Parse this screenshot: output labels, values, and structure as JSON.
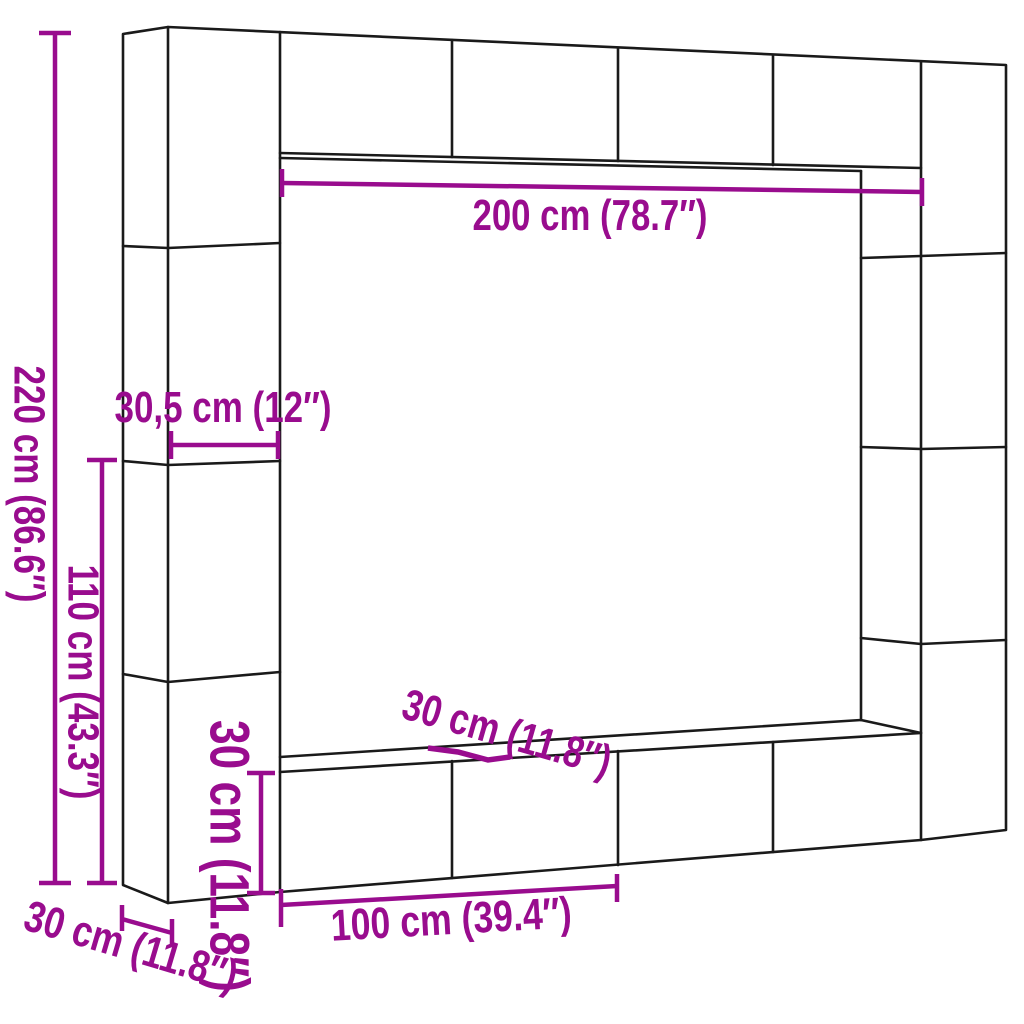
{
  "colors": {
    "dimension": "#990c8e",
    "outline": "#1a1a1a",
    "background": "#ffffff"
  },
  "dimensions": {
    "inner_width": {
      "label": "200 cm (78.7″)",
      "cm": "200",
      "inches": "78.7"
    },
    "total_height": {
      "label": "220 cm (86.6″)",
      "cm": "220",
      "inches": "86.6"
    },
    "column_width": {
      "label": "30,5 cm (12″)",
      "cm": "30,5",
      "inches": "12"
    },
    "lower_height": {
      "label": "110 cm (43.3″)",
      "cm": "110",
      "inches": "43.3"
    },
    "bottom_cabinet_height": {
      "label": "30 cm (11.8″)",
      "cm": "30",
      "inches": "11.8"
    },
    "bottom_cabinet_depth": {
      "label": "30 cm (11.8″)",
      "cm": "30",
      "inches": "11.8"
    },
    "bottom_cabinet_width": {
      "label": "100 cm (39.4″)",
      "cm": "100",
      "inches": "39.4"
    },
    "side_column_depth": {
      "label": "30 cm (11.8″)",
      "cm": "30",
      "inches": "11.8"
    }
  }
}
